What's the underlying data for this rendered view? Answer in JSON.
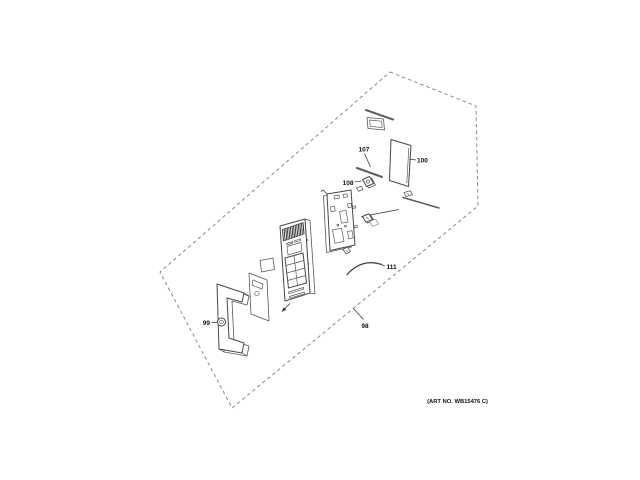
{
  "figure": {
    "art_no": "(ART NO. WB15476 C)"
  },
  "callouts": {
    "c98": "98",
    "c99": "99",
    "c100": "100",
    "c107": "107",
    "c108": "108",
    "c111": "111"
  },
  "colors": {
    "ink": "#2f2f2f",
    "boundary_dash": "#8a8a8a",
    "background": "#ffffff"
  }
}
